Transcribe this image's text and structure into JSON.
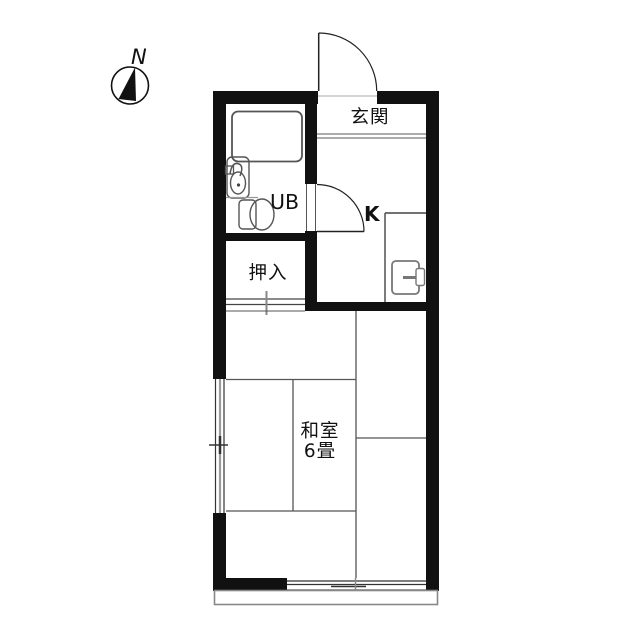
{
  "plan": {
    "compass": {
      "label": "N"
    },
    "rooms": {
      "genkan": {
        "label": "玄関"
      },
      "unit_bath": {
        "label": "UB"
      },
      "kitchen": {
        "label": "K"
      },
      "closet": {
        "label": "押入"
      },
      "washitsu": {
        "label": "和室",
        "size": "6畳"
      }
    },
    "colors": {
      "wall": "#111111",
      "fixture_line": "#555555",
      "tatami_line": "#555555",
      "step_line": "#909090",
      "balcony_line": "#888888",
      "text": "#111111",
      "background": "#ffffff"
    }
  }
}
